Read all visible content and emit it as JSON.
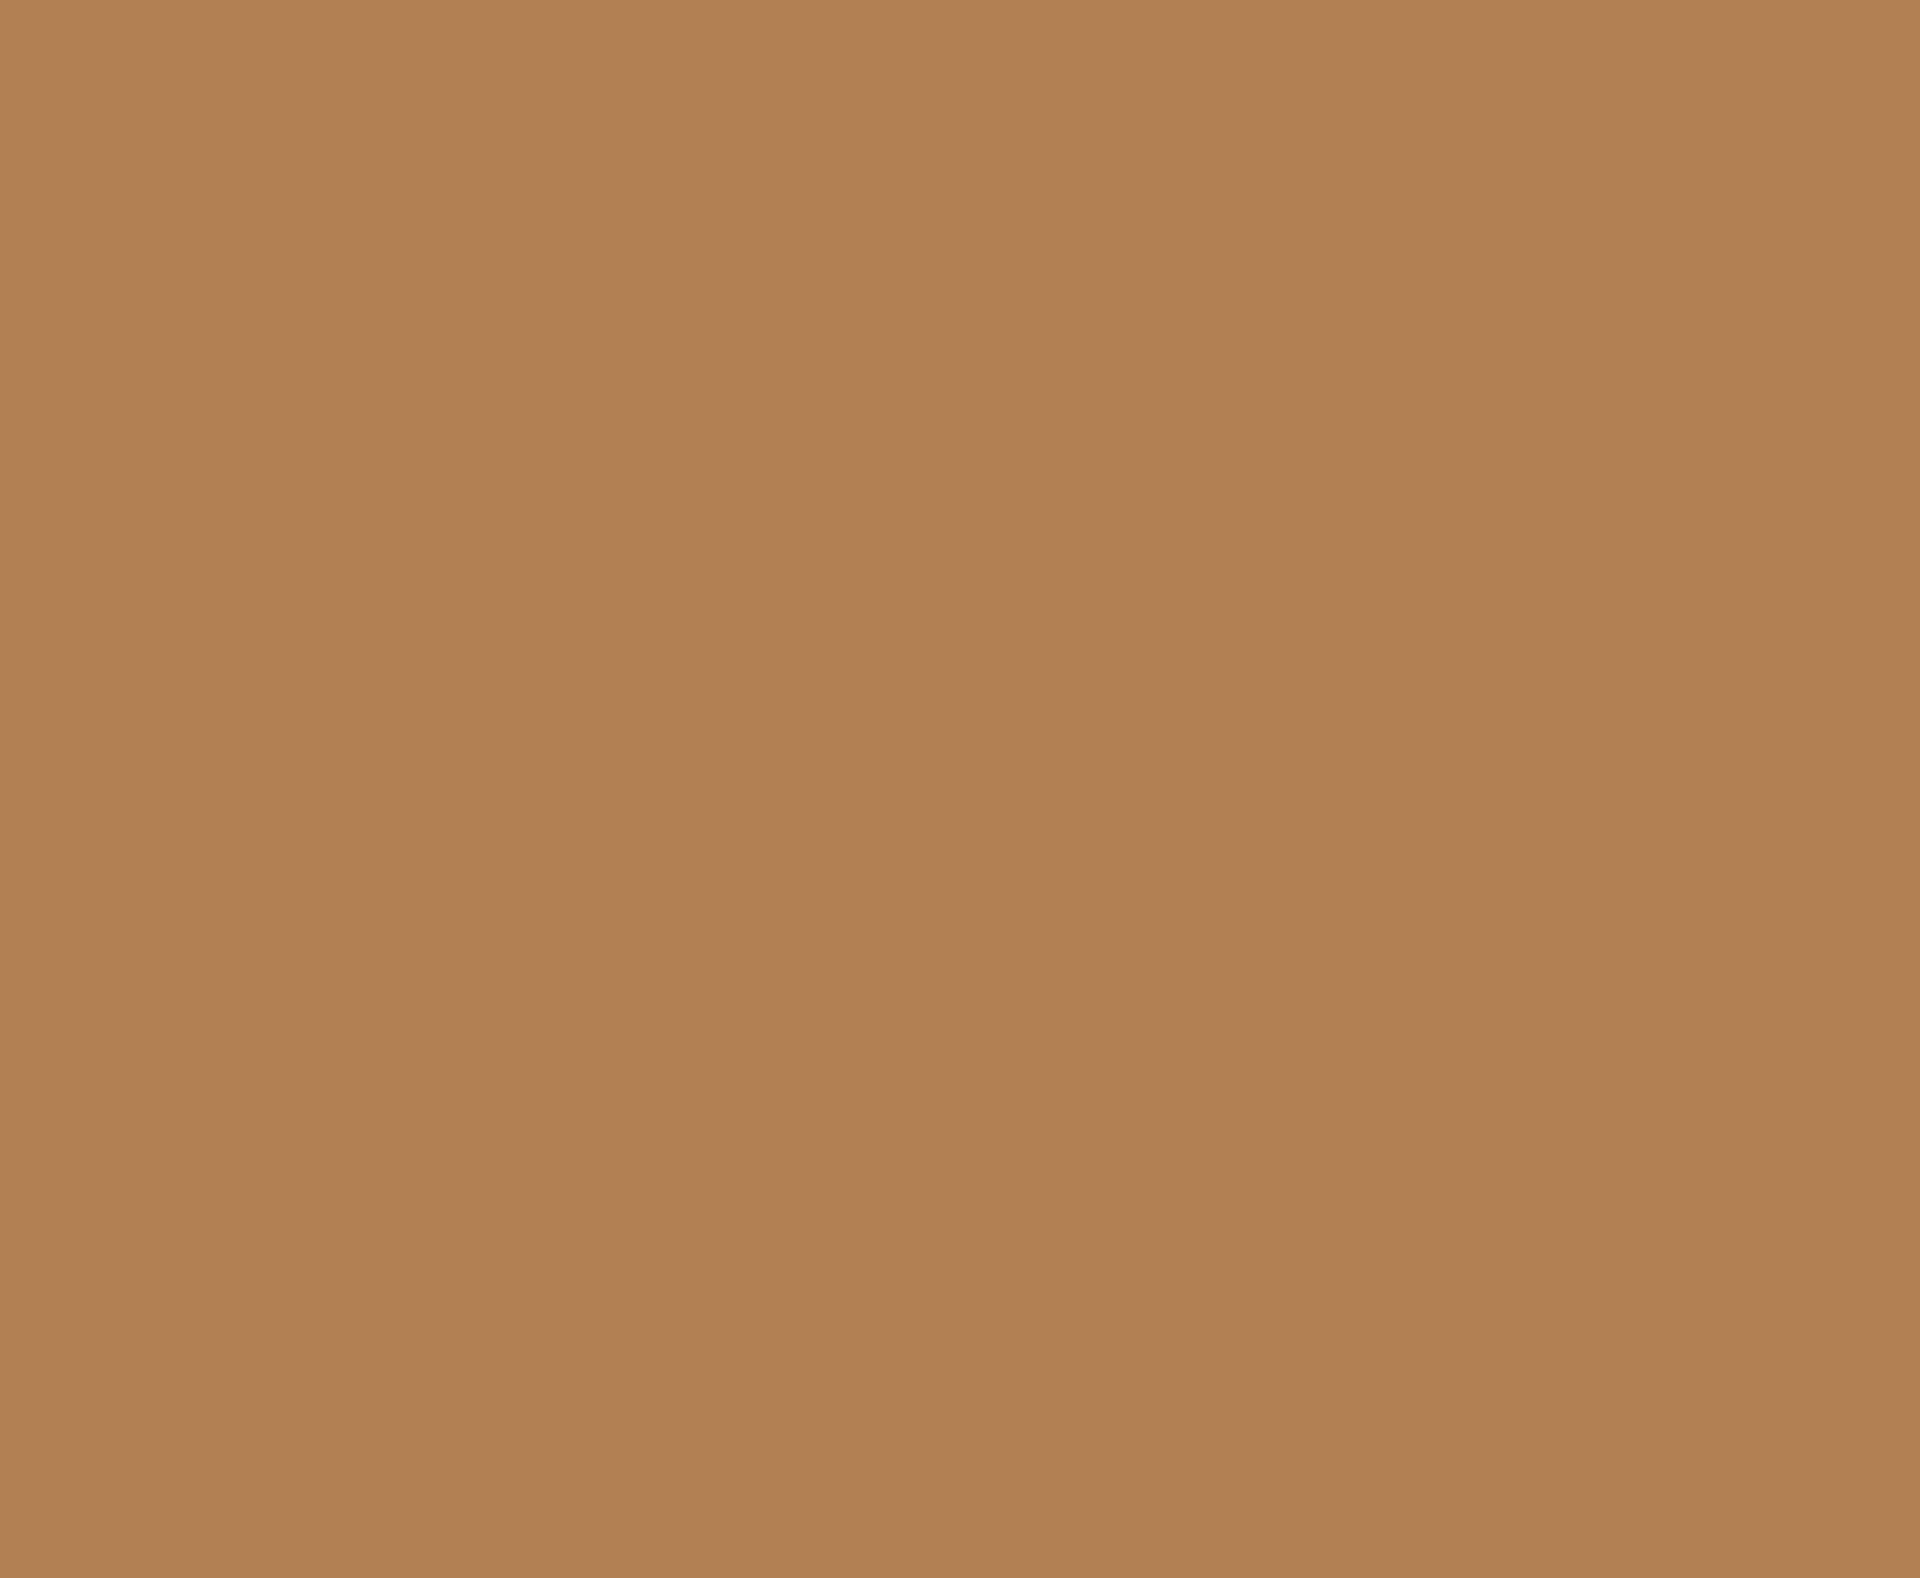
{
  "canvas": {
    "description": "uniform solid color field, no visible text or UI elements",
    "colors": {
      "background": "#B28053"
    }
  }
}
